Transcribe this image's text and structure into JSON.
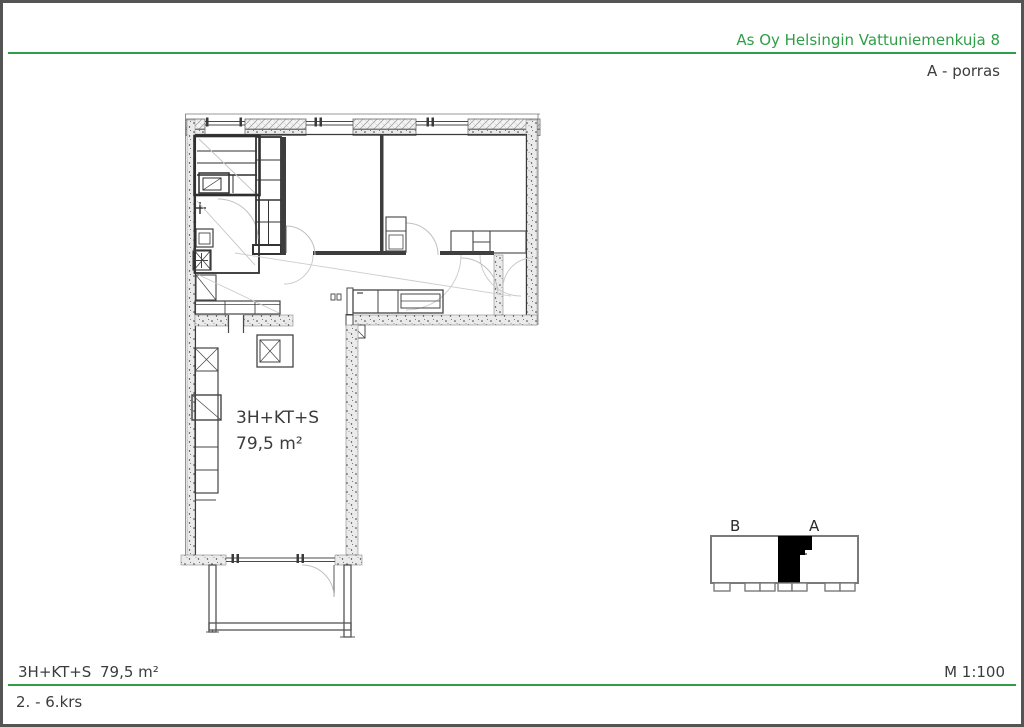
{
  "page": {
    "accent_green": "#2f9e47",
    "border_color": "#545454",
    "text_color": "#3c3c3c"
  },
  "header": {
    "company": "As Oy Helsingin Vattuniemenkuja 8",
    "staircase": "A - porras"
  },
  "floor_plan": {
    "apartment_type": "3H+KT+S",
    "area": "79,5 m²"
  },
  "key_plan": {
    "label_b": "B",
    "label_a": "A"
  },
  "footer": {
    "apartment_type": "3H+KT+S",
    "area": "79,5 m²",
    "scale": "M 1:100",
    "floors": "2. - 6.krs"
  }
}
